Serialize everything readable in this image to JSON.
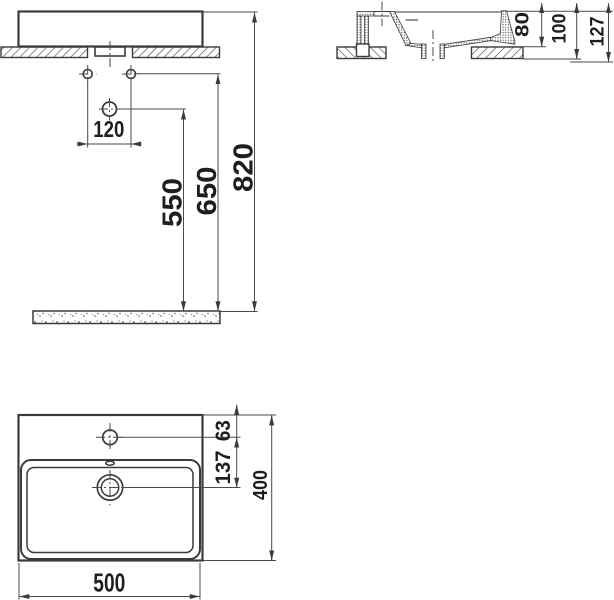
{
  "dims": {
    "front": {
      "hole_spacing": "120",
      "drain_height": "550",
      "supply_height": "650",
      "rim_height": "820"
    },
    "side": {
      "front_edge_depth": "80",
      "mount_depth": "100",
      "total_depth": "127"
    },
    "plan": {
      "faucet_inset": "63",
      "faucet_to_drain": "137",
      "depth": "400",
      "width": "500"
    }
  },
  "colors": {
    "line": "#3b3b3b",
    "dimension_line": "#4a4a4a",
    "text": "#1e1e1e",
    "background": "#ffffff"
  }
}
